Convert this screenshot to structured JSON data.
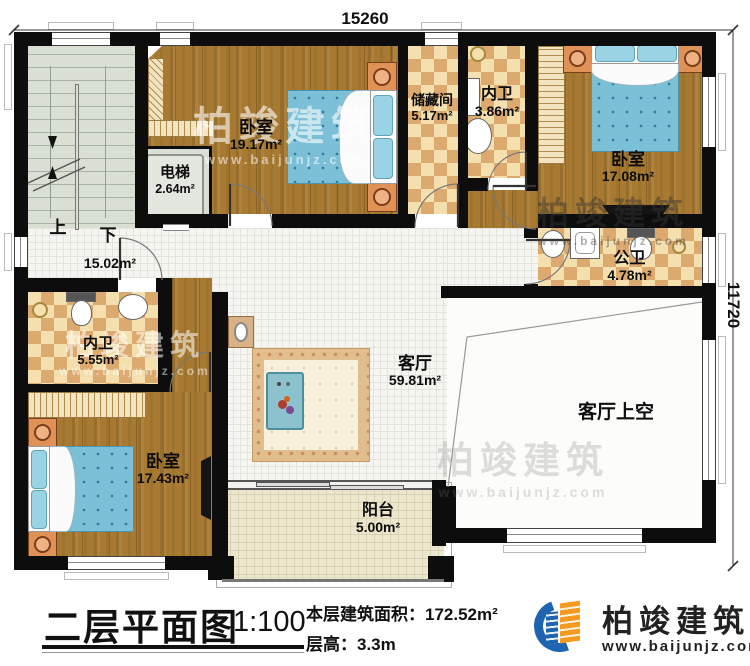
{
  "dimensions": {
    "width_top": "15260",
    "height_right": "11720"
  },
  "rooms": {
    "bedroom1": {
      "name": "卧室",
      "area": "19.17m²"
    },
    "storage": {
      "name": "储藏间",
      "area": "5.17m²"
    },
    "bath1": {
      "name": "内卫",
      "area": "3.86m²"
    },
    "bedroom2": {
      "name": "卧室",
      "area": "17.08m²"
    },
    "public_bath": {
      "name": "公卫",
      "area": "4.78m²"
    },
    "elevator": {
      "name": "电梯",
      "area": "2.64m²"
    },
    "hall": {
      "up": "上",
      "down": "下",
      "area": "15.02m²"
    },
    "bath2": {
      "name": "内卫",
      "area": "5.55m²"
    },
    "bedroom3": {
      "name": "卧室",
      "area": "17.43m²"
    },
    "living": {
      "name": "客厅",
      "area": "59.81m²"
    },
    "living_void": {
      "name": "客厅上空"
    },
    "balcony": {
      "name": "阳台",
      "area": "5.00m²"
    }
  },
  "title_block": {
    "plan_title": "二层平面图",
    "scale": "1:100",
    "area_label": "本层建筑面积：",
    "area_value": "172.52m²",
    "floor_height_label": "层高：",
    "floor_height_value": "3.3m"
  },
  "brand": {
    "name": "柏竣建筑",
    "website": "www.baijunjz.com"
  },
  "watermark": {
    "text": "柏竣建筑",
    "website": "www.baijunjz.com"
  },
  "colors": {
    "wall": "#0d0d0d",
    "bed_blue": "#7cc0d8",
    "accent_blue": "#1f64b0",
    "accent_orange": "#f59a1e"
  }
}
